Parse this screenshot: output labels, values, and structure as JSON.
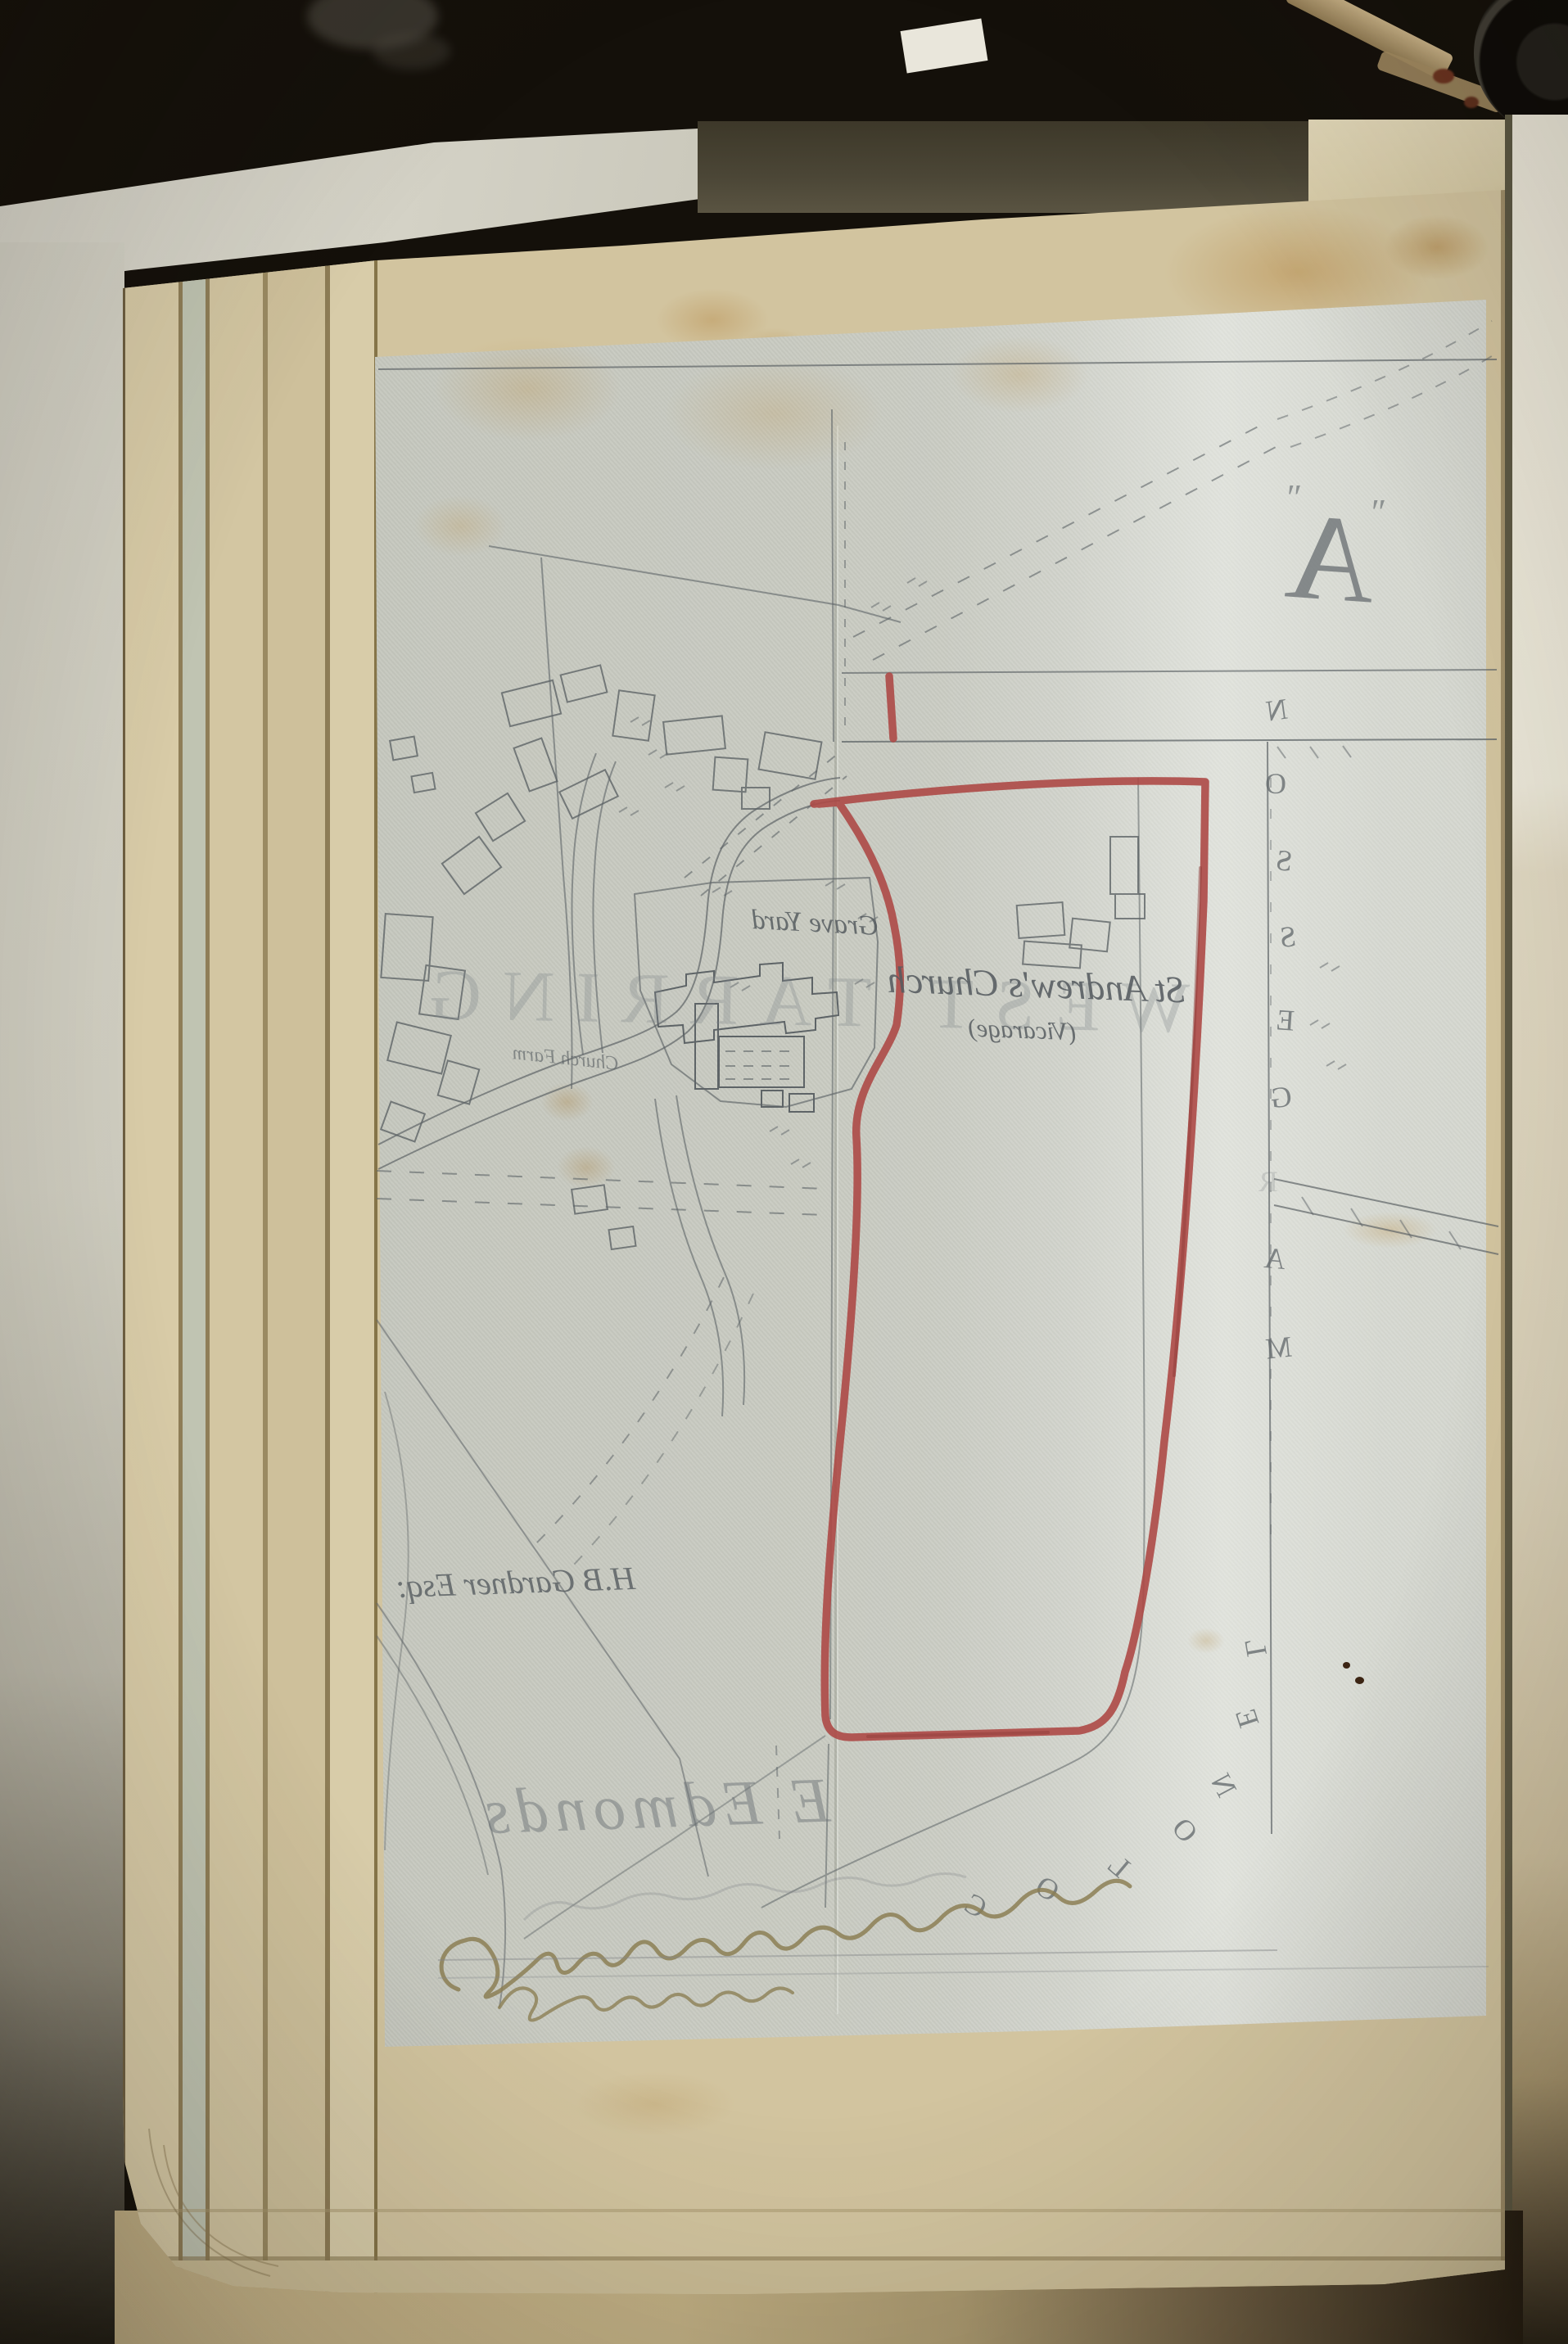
{
  "photo": {
    "background_color": "#14100a",
    "backing_sheet_color": "#d6d4c8",
    "page_color": "#d2c49f",
    "tracing_paper_color": "#c7c9c0",
    "red_boundary_color": "#ad4946",
    "pencil_color": "#5e6467",
    "ink_color": "#8c7f55",
    "stain_color": "#b98f4f"
  },
  "map": {
    "exhibit_letter": "A",
    "quote_mark": "″",
    "parish_name": "WEST TARRING",
    "labels": {
      "graveyard": "Grave Yard",
      "church": "St Andrew's Church",
      "vicarage": "(Vicarage)",
      "owner_west": "H.B Gardner Esq:",
      "farm": "Church Farm"
    },
    "owner_east": {
      "reading": "COLONEL MARGESSON",
      "colonel_letters": [
        "C",
        "O",
        "L",
        "O",
        "N",
        "E",
        "L"
      ],
      "margesson_letters": [
        "M",
        "A",
        "R",
        "G",
        "E",
        "S",
        "S",
        "O",
        "N"
      ]
    },
    "signature_pencil": "E Edmonds"
  }
}
